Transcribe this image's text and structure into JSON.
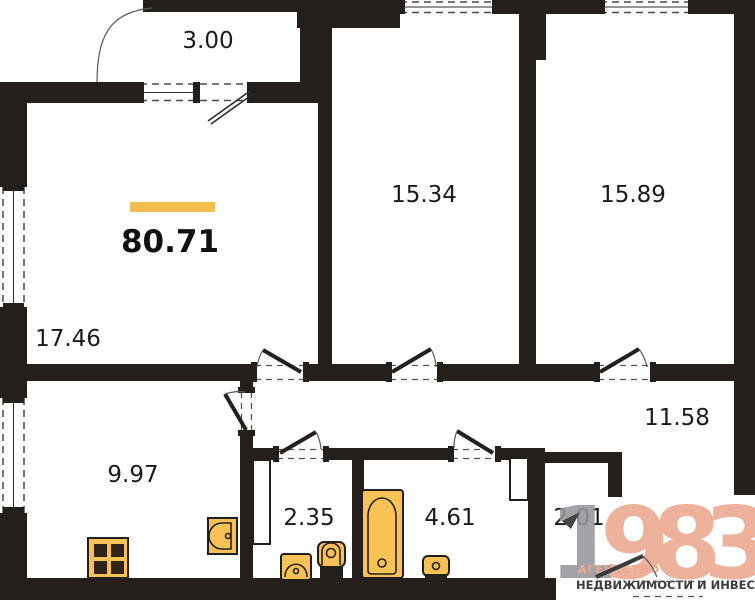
{
  "total_area": {
    "value": "80.71"
  },
  "rooms": [
    {
      "id": "balcony",
      "area": "3.00"
    },
    {
      "id": "bedroom-1",
      "area": "15.34"
    },
    {
      "id": "bedroom-2",
      "area": "15.89"
    },
    {
      "id": "living-room",
      "area": "17.46"
    },
    {
      "id": "kitchen",
      "area": "9.97"
    },
    {
      "id": "wc",
      "area": "2.35"
    },
    {
      "id": "bathroom",
      "area": "4.61"
    },
    {
      "id": "hallway",
      "area": "11.58"
    },
    {
      "id": "wardrobe",
      "area": "2.01"
    }
  ],
  "logo": {
    "digits_gray": "1",
    "digits_salmon": "983",
    "line1": "АГЕНТСТВО",
    "line2": "НЕДВИЖИМОСТИ И ИНВЕСТИЦИЙ"
  },
  "colors": {
    "wall": "#241F1B",
    "accent": "#F2BC4F",
    "fixture": "#F9C255",
    "burner": "#2E2418",
    "salmon": "#EBA88E",
    "graydigit": "#97979B",
    "darktext": "#3B3B3D"
  }
}
